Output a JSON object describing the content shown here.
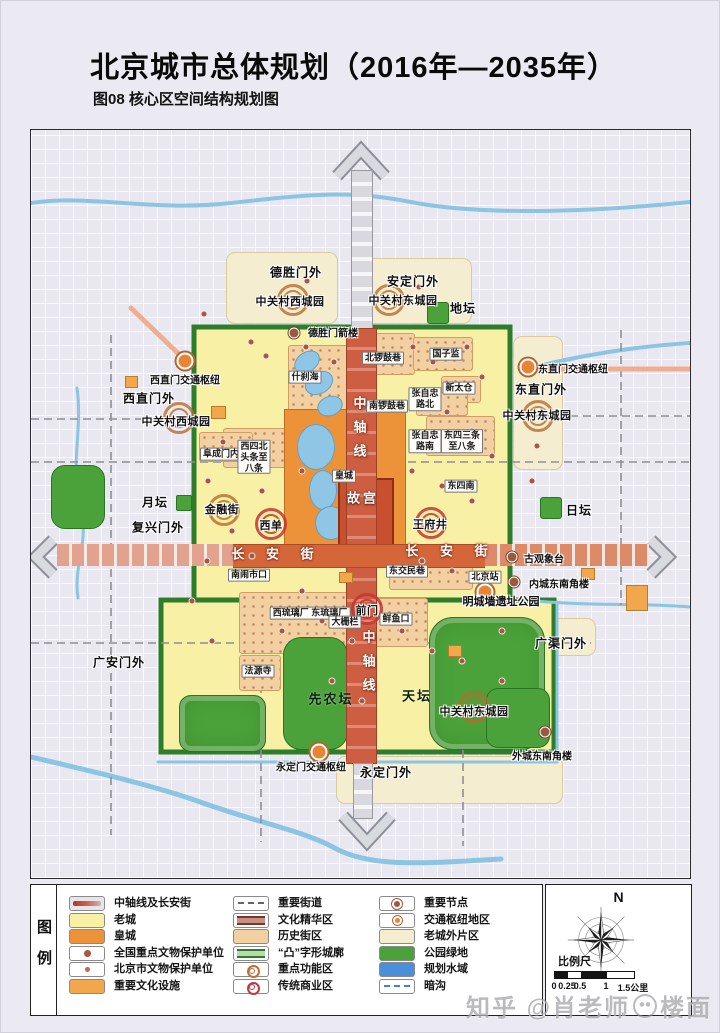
{
  "title": "北京城市总体规划（2016年—2035年）",
  "subtitle": "图08 核心区空间结构规划图",
  "legend": {
    "panel_label": "图例",
    "columns": [
      [
        {
          "type": "axis",
          "label": "中轴线及长安街"
        },
        {
          "type": "oldcity",
          "label": "老城"
        },
        {
          "type": "imperial",
          "label": "皇城"
        },
        {
          "type": "natsite",
          "label": "全国重点文物保护单位"
        },
        {
          "type": "citysite",
          "label": "北京市文物保护单位"
        },
        {
          "type": "culture",
          "label": "重要文化设施"
        }
      ],
      [
        {
          "type": "street",
          "label": "重要街道"
        },
        {
          "type": "culturearea",
          "label": "文化精华区"
        },
        {
          "type": "historic",
          "label": "历史街区"
        },
        {
          "type": "tuwall",
          "label": "“凸”字形城廓"
        },
        {
          "type": "functional",
          "label": "重点功能区"
        },
        {
          "type": "commercial",
          "label": "传统商业区"
        }
      ],
      [
        {
          "type": "node",
          "label": "重要节点"
        },
        {
          "type": "hubarea",
          "label": "交通枢纽地区"
        },
        {
          "type": "outer",
          "label": "老城外片区"
        },
        {
          "type": "park",
          "label": "公园绿地"
        },
        {
          "type": "water",
          "label": "规划水域"
        },
        {
          "type": "culvert",
          "label": "暗沟"
        }
      ]
    ]
  },
  "compass": {
    "north": "N",
    "scale_label": "比例尺",
    "ticks": [
      "0",
      "0.25",
      "0.5",
      "1",
      "1.5公里"
    ],
    "tick_offsets": [
      0,
      13,
      26,
      52,
      79
    ],
    "bar_segments": [
      13,
      13,
      26,
      27
    ]
  },
  "watermark": {
    "prefix": "知乎 @肖老师",
    "suffix": "楼面"
  },
  "colors": {
    "old_city": "#f8f0a5",
    "imperial_city": "#ec9339",
    "palace": "#c8502f",
    "axis_red": "#cd5e41",
    "changan_orange": "#d4663a",
    "wall_green": "#2e7d2a",
    "park_green": "#4ba23a",
    "water_blue": "#8fc6e6",
    "planned_water": "#4a90d9",
    "historic_tan": "#f3d0a2",
    "outer_district_cream": "#f5edd0",
    "map_bg": "#e9e8f0"
  },
  "map": {
    "outer_districts": [
      [
        225,
        252,
        110,
        70
      ],
      [
        357,
        258,
        112,
        64
      ],
      [
        512,
        336,
        48,
        132
      ],
      [
        335,
        756,
        225,
        46
      ],
      [
        548,
        618,
        45,
        36
      ]
    ],
    "historic_districts": [
      [
        287,
        345,
        75,
        85
      ],
      [
        368,
        333,
        44,
        40
      ],
      [
        412,
        337,
        58,
        32
      ],
      [
        440,
        376,
        38,
        25
      ],
      [
        415,
        392,
        50,
        22
      ],
      [
        425,
        416,
        67,
        38
      ],
      [
        222,
        428,
        70,
        38
      ],
      [
        198,
        432,
        52,
        28
      ],
      [
        388,
        558,
        82,
        30
      ],
      [
        238,
        592,
        124,
        60
      ],
      [
        365,
        598,
        60,
        47
      ],
      [
        238,
        655,
        40,
        34
      ]
    ],
    "imperial_city": [
      283,
      409,
      120,
      152
    ],
    "forbidden_city": [
      337,
      478,
      52,
      74
    ],
    "lakes": [
      [
        292,
        352,
        26,
        18,
        -35
      ],
      [
        303,
        372,
        28,
        20,
        -30
      ],
      [
        316,
        396,
        24,
        18,
        -20
      ],
      [
        296,
        424,
        36,
        44,
        0
      ],
      [
        308,
        470,
        26,
        38,
        0
      ],
      [
        314,
        506,
        30,
        32,
        0
      ],
      [
        58,
        478,
        36,
        42,
        0
      ],
      [
        212,
        710,
        34,
        19,
        0
      ],
      [
        498,
        698,
        32,
        22,
        0
      ]
    ],
    "parks": [
      [
        428,
        617,
        114,
        131,
        24
      ],
      [
        282,
        637,
        63,
        111,
        18
      ],
      [
        485,
        688,
        62,
        58,
        12
      ],
      [
        178,
        695,
        85,
        55,
        12
      ],
      [
        426,
        302,
        20,
        20,
        3
      ],
      [
        539,
        497,
        20,
        20,
        3
      ],
      [
        175,
        495,
        14,
        14,
        2
      ],
      [
        50,
        465,
        52,
        62,
        14
      ],
      [
        348,
        452,
        26,
        20,
        5
      ],
      [
        332,
        546,
        18,
        13,
        4
      ]
    ],
    "culture_facilities": [
      [
        210,
        406,
        13,
        11
      ],
      [
        625,
        585,
        20,
        24
      ],
      [
        124,
        376,
        11,
        10
      ],
      [
        447,
        645,
        12,
        10
      ],
      [
        580,
        568,
        12,
        10
      ],
      [
        338,
        572,
        12,
        9
      ]
    ],
    "poi_dots": [
      [
        250,
        342
      ],
      [
        265,
        356
      ],
      [
        305,
        347
      ],
      [
        333,
        362
      ],
      [
        412,
        347
      ],
      [
        432,
        362
      ],
      [
        466,
        347
      ],
      [
        481,
        377
      ],
      [
        446,
        412
      ],
      [
        471,
        431
      ],
      [
        491,
        456
      ],
      [
        222,
        442
      ],
      [
        241,
        461
      ],
      [
        207,
        481
      ],
      [
        261,
        491
      ],
      [
        301,
        471
      ],
      [
        411,
        471
      ],
      [
        441,
        486
      ],
      [
        471,
        501
      ],
      [
        231,
        531
      ],
      [
        206,
        561
      ],
      [
        251,
        556
      ],
      [
        421,
        561
      ],
      [
        451,
        571
      ],
      [
        301,
        591
      ],
      [
        321,
        621
      ],
      [
        281,
        631
      ],
      [
        351,
        641
      ],
      [
        401,
        631
      ],
      [
        431,
        651
      ],
      [
        461,
        661
      ],
      [
        501,
        631
      ],
      [
        331,
        681
      ],
      [
        361,
        701
      ],
      [
        501,
        681
      ],
      [
        191,
        601
      ],
      [
        211,
        641
      ],
      [
        531,
        481
      ],
      [
        306,
        281
      ],
      [
        418,
        287
      ],
      [
        203,
        314
      ],
      [
        536,
        446
      ]
    ],
    "site_dots": [
      [
        293,
        333
      ],
      [
        511,
        557
      ],
      [
        513,
        582
      ],
      [
        544,
        732
      ]
    ],
    "hub_dots": [
      [
        184,
        361
      ],
      [
        527,
        367
      ],
      [
        318,
        752
      ],
      [
        484,
        592
      ]
    ],
    "rings": [
      {
        "x": 292,
        "y": 300,
        "k": "o"
      },
      {
        "x": 388,
        "y": 300,
        "k": "o"
      },
      {
        "x": 178,
        "y": 418,
        "k": "o"
      },
      {
        "x": 537,
        "y": 416,
        "k": "o"
      },
      {
        "x": 473,
        "y": 707,
        "k": "o"
      },
      {
        "x": 223,
        "y": 510,
        "k": "o"
      },
      {
        "x": 270,
        "y": 524,
        "k": "r"
      },
      {
        "x": 430,
        "y": 523,
        "k": "r"
      },
      {
        "x": 366,
        "y": 609,
        "k": "r"
      }
    ],
    "labels": [
      {
        "t": "德胜门外",
        "x": 295,
        "y": 272,
        "c": "district"
      },
      {
        "t": "安定门外",
        "x": 412,
        "y": 281,
        "c": "district"
      },
      {
        "t": "地坛",
        "x": 462,
        "y": 308,
        "c": "district"
      },
      {
        "t": "西直门外",
        "x": 148,
        "y": 398,
        "c": "district"
      },
      {
        "t": "东直门外",
        "x": 540,
        "y": 389,
        "c": "district"
      },
      {
        "t": "月坛",
        "x": 154,
        "y": 502,
        "c": "district"
      },
      {
        "t": "复兴门外",
        "x": 157,
        "y": 527,
        "c": "district"
      },
      {
        "t": "日坛",
        "x": 578,
        "y": 510,
        "c": "district"
      },
      {
        "t": "广安门外",
        "x": 118,
        "y": 662,
        "c": "district"
      },
      {
        "t": "广渠门外",
        "x": 560,
        "y": 643,
        "c": "district"
      },
      {
        "t": "永定门外",
        "x": 385,
        "y": 772,
        "c": "district"
      },
      {
        "t": "中关村西城园",
        "x": 289,
        "y": 301,
        "c": "ring"
      },
      {
        "t": "中关村东城园",
        "x": 402,
        "y": 300,
        "c": "ring"
      },
      {
        "t": "中关村西城园",
        "x": 175,
        "y": 421,
        "c": "ring"
      },
      {
        "t": "中关村东城园",
        "x": 536,
        "y": 415,
        "c": "ring"
      },
      {
        "t": "中关村东城园",
        "x": 473,
        "y": 711,
        "c": "ring"
      },
      {
        "t": "金融街",
        "x": 221,
        "y": 509,
        "c": "ring"
      },
      {
        "t": "西单",
        "x": 270,
        "y": 525,
        "c": "red"
      },
      {
        "t": "王府井",
        "x": 429,
        "y": 524,
        "c": "red"
      },
      {
        "t": "前门",
        "x": 366,
        "y": 610,
        "c": "red"
      },
      {
        "t": "西直门交通枢纽",
        "x": 184,
        "y": 379,
        "c": "hub"
      },
      {
        "t": "东直门交通枢纽",
        "x": 572,
        "y": 368,
        "c": "hub"
      },
      {
        "t": "永定门交通枢纽",
        "x": 310,
        "y": 766,
        "c": "hub"
      },
      {
        "t": "德胜门箭楼",
        "x": 332,
        "y": 332,
        "c": "site"
      },
      {
        "t": "古观象台",
        "x": 543,
        "y": 558,
        "c": "site"
      },
      {
        "t": "内城东南角楼",
        "x": 558,
        "y": 583,
        "c": "site"
      },
      {
        "t": "外城东南角楼",
        "x": 541,
        "y": 755,
        "c": "site"
      },
      {
        "t": "北京站",
        "x": 484,
        "y": 577,
        "c": "box"
      },
      {
        "t": "什刹海",
        "x": 304,
        "y": 377,
        "c": "box"
      },
      {
        "t": "北锣鼓巷",
        "x": 382,
        "y": 358,
        "c": "box"
      },
      {
        "t": "国子监",
        "x": 445,
        "y": 354,
        "c": "box"
      },
      {
        "t": "新太仓",
        "x": 458,
        "y": 388,
        "c": "box"
      },
      {
        "t": "张自忠\n路北",
        "x": 424,
        "y": 399,
        "c": "box"
      },
      {
        "t": "南锣鼓巷",
        "x": 386,
        "y": 406,
        "c": "box"
      },
      {
        "t": "张自忠\n路南",
        "x": 424,
        "y": 441,
        "c": "box"
      },
      {
        "t": "东四三条\n至八条",
        "x": 461,
        "y": 441,
        "c": "box"
      },
      {
        "t": "东四南",
        "x": 460,
        "y": 486,
        "c": "box"
      },
      {
        "t": "阜成门内",
        "x": 220,
        "y": 454,
        "c": "box"
      },
      {
        "t": "西四北\n头条至\n八条",
        "x": 253,
        "y": 457,
        "c": "box"
      },
      {
        "t": "东交民巷",
        "x": 406,
        "y": 571,
        "c": "box"
      },
      {
        "t": "南闹市口",
        "x": 248,
        "y": 575,
        "c": "box"
      },
      {
        "t": "西琉璃厂 东琉璃厂",
        "x": 309,
        "y": 613,
        "c": "box"
      },
      {
        "t": "大栅栏",
        "x": 344,
        "y": 622,
        "c": "box"
      },
      {
        "t": "鲜鱼口",
        "x": 395,
        "y": 619,
        "c": "box"
      },
      {
        "t": "法源寺",
        "x": 257,
        "y": 671,
        "c": "box"
      },
      {
        "t": "皇城",
        "x": 343,
        "y": 476,
        "c": "box"
      },
      {
        "t": "先农坛",
        "x": 330,
        "y": 698,
        "c": "park"
      },
      {
        "t": "天坛",
        "x": 416,
        "y": 695,
        "c": "park"
      },
      {
        "t": "故宫",
        "x": 362,
        "y": 497,
        "c": "gugong"
      },
      {
        "t": "长 安 街",
        "x": 276,
        "y": 553,
        "c": "street"
      },
      {
        "t": "长 安 街",
        "x": 450,
        "y": 550,
        "c": "street"
      },
      {
        "t": "中轴线",
        "x": 358,
        "y": 432,
        "c": "axisv"
      },
      {
        "t": "中轴线",
        "x": 367,
        "y": 666,
        "c": "axisv"
      },
      {
        "t": "明城墙遗址公园",
        "x": 500,
        "y": 601,
        "c": "wall"
      }
    ]
  }
}
